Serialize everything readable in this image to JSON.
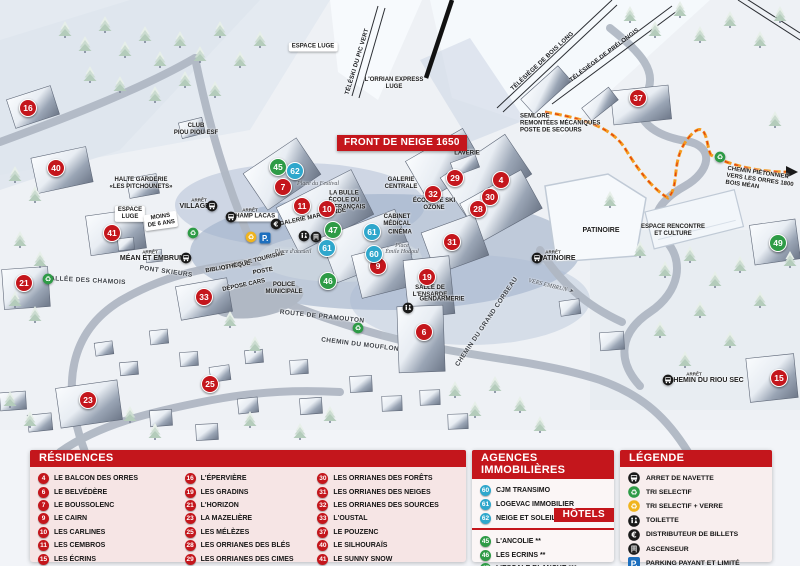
{
  "map": {
    "banner": "FRONT DE NEIGE 1650",
    "markers": [
      {
        "n": "16",
        "t": "res",
        "x": 28,
        "y": 108
      },
      {
        "n": "40",
        "t": "res",
        "x": 56,
        "y": 168
      },
      {
        "n": "41",
        "t": "res",
        "x": 112,
        "y": 233
      },
      {
        "n": "21",
        "t": "res",
        "x": 24,
        "y": 283
      },
      {
        "n": "33",
        "t": "res",
        "x": 204,
        "y": 297
      },
      {
        "n": "23",
        "t": "res",
        "x": 88,
        "y": 400
      },
      {
        "n": "25",
        "t": "res",
        "x": 210,
        "y": 384
      },
      {
        "n": "7",
        "t": "res",
        "x": 283,
        "y": 187
      },
      {
        "n": "11",
        "t": "res",
        "x": 302,
        "y": 206
      },
      {
        "n": "10",
        "t": "res",
        "x": 327,
        "y": 209
      },
      {
        "n": "9",
        "t": "res",
        "x": 378,
        "y": 266
      },
      {
        "n": "19",
        "t": "res",
        "x": 427,
        "y": 277
      },
      {
        "n": "6",
        "t": "res",
        "x": 424,
        "y": 332
      },
      {
        "n": "29",
        "t": "res",
        "x": 455,
        "y": 178
      },
      {
        "n": "32",
        "t": "res",
        "x": 433,
        "y": 194
      },
      {
        "n": "4",
        "t": "res",
        "x": 501,
        "y": 180
      },
      {
        "n": "30",
        "t": "res",
        "x": 490,
        "y": 197
      },
      {
        "n": "28",
        "t": "res",
        "x": 478,
        "y": 209
      },
      {
        "n": "31",
        "t": "res",
        "x": 452,
        "y": 242
      },
      {
        "n": "37",
        "t": "res",
        "x": 638,
        "y": 98
      },
      {
        "n": "15",
        "t": "res",
        "x": 779,
        "y": 378
      },
      {
        "n": "45",
        "t": "hotel",
        "x": 278,
        "y": 167
      },
      {
        "n": "47",
        "t": "hotel",
        "x": 333,
        "y": 230
      },
      {
        "n": "46",
        "t": "hotel",
        "x": 328,
        "y": 281
      },
      {
        "n": "49",
        "t": "hotel",
        "x": 778,
        "y": 243
      },
      {
        "n": "62",
        "t": "agency",
        "x": 295,
        "y": 171
      },
      {
        "n": "61",
        "t": "agency",
        "x": 327,
        "y": 248
      },
      {
        "n": "61",
        "t": "agency",
        "x": 372,
        "y": 232
      },
      {
        "n": "60",
        "t": "agency",
        "x": 374,
        "y": 254
      }
    ],
    "labels": [
      {
        "text": "ESPACE LUGE",
        "x": 313,
        "y": 47,
        "cls": "pill"
      },
      {
        "text": "CLUB\nPIOU PIOU ESF",
        "x": 196,
        "y": 130
      },
      {
        "text": "HALTE GARDERIE\n«LES PITCHOUNETS»",
        "x": 141,
        "y": 184
      },
      {
        "text": "ARRÊT",
        "x": 199,
        "y": 200,
        "cls": "tiny"
      },
      {
        "text": "VILLAGES",
        "x": 197,
        "y": 207,
        "cls": "big"
      },
      {
        "text": "ARRÊT",
        "x": 250,
        "y": 210,
        "cls": "tiny"
      },
      {
        "text": "CHAMP LACAS",
        "x": 253,
        "y": 217,
        "cls": "pill"
      },
      {
        "text": "ESPACE\nLUGE",
        "x": 130,
        "y": 214,
        "cls": "pill"
      },
      {
        "text": "MOINS\nDE 6 ANS",
        "x": 161,
        "y": 221,
        "cls": "pill",
        "rot": -8
      },
      {
        "text": "ARRÊT",
        "x": 150,
        "y": 252,
        "cls": "tiny"
      },
      {
        "text": "MÉAN ET EMBRUN",
        "x": 152,
        "y": 259,
        "cls": "big"
      },
      {
        "text": "ALLÉE DES CHAMOIS",
        "x": 88,
        "y": 281,
        "cls": "road",
        "rot": 3
      },
      {
        "text": "PONT SKIEURS",
        "x": 166,
        "y": 272,
        "cls": "road",
        "rot": 8
      },
      {
        "text": "Place du Festival",
        "x": 318,
        "y": 184,
        "cls": "ital"
      },
      {
        "text": "LA BULLE\nÉCOLE DU\nSKI FRANÇAIS",
        "x": 344,
        "y": 201
      },
      {
        "text": "GALERIE MARCHANDE",
        "x": 313,
        "y": 218,
        "rot": -12
      },
      {
        "text": "GALERIE\nCENTRALE",
        "x": 401,
        "y": 184
      },
      {
        "text": "ÉCOLE DE SKI\nOZONE",
        "x": 434,
        "y": 205
      },
      {
        "text": "CABINET\nMÉDICAL",
        "x": 397,
        "y": 221
      },
      {
        "text": "CINÉMA",
        "x": 400,
        "y": 233
      },
      {
        "text": "Place\nÉmile Hodoul",
        "x": 402,
        "y": 249,
        "cls": "ital"
      },
      {
        "text": "LAVERIE",
        "x": 467,
        "y": 154
      },
      {
        "text": "OFFICE DE TOURISME",
        "x": 253,
        "y": 262,
        "rot": -14
      },
      {
        "text": "BIBLIOTHÈQUE",
        "x": 228,
        "y": 268,
        "rot": -10
      },
      {
        "text": "POSTE",
        "x": 263,
        "y": 272,
        "rot": -10
      },
      {
        "text": "DÉPOSE CARS",
        "x": 244,
        "y": 286,
        "rot": -12
      },
      {
        "text": "POLICE\nMUNICIPALE",
        "x": 284,
        "y": 289
      },
      {
        "text": "Place d'accueil",
        "x": 293,
        "y": 252,
        "cls": "ital"
      },
      {
        "text": "ROUTE DE PRAMOUTON",
        "x": 322,
        "y": 317,
        "cls": "road",
        "rot": 6
      },
      {
        "text": "CHEMIN DU MOUFLON",
        "x": 360,
        "y": 345,
        "cls": "road",
        "rot": 7
      },
      {
        "text": "CHEMIN DU GRAND CORBEAU",
        "x": 487,
        "y": 322,
        "cls": "road",
        "rot": -56
      },
      {
        "text": "SALLE DE\nL'ENSARDE",
        "x": 430,
        "y": 292
      },
      {
        "text": "GENDARMERIE",
        "x": 442,
        "y": 300
      },
      {
        "text": "PATINOIRE",
        "x": 601,
        "y": 231,
        "cls": "big"
      },
      {
        "text": "ARRÊT",
        "x": 553,
        "y": 252,
        "cls": "tiny"
      },
      {
        "text": "PATINOIRE",
        "x": 557,
        "y": 259,
        "cls": "big"
      },
      {
        "text": "VERS EMBRUN ➤",
        "x": 551,
        "y": 286,
        "cls": "ital",
        "rot": 14
      },
      {
        "text": "ESPACE RENCONTRE\nET CULTURE",
        "x": 673,
        "y": 231
      },
      {
        "text": "SEMLORE\nREMONTÉES MÉCANIQUES\nPOSTE DE SECOURS",
        "x": 520,
        "y": 124,
        "cls": "left"
      },
      {
        "text": "TÉLÉSKI DU PIC VERT",
        "x": 358,
        "y": 62,
        "cls": "lift",
        "rot": -73
      },
      {
        "text": "L'ORRIAN EXPRESS\nLUGE",
        "x": 394,
        "y": 84
      },
      {
        "text": "TÉLÉSIÈGE DE BOIS LONG",
        "x": 543,
        "y": 62,
        "cls": "lift",
        "rot": -43
      },
      {
        "text": "TÉLÉSIÈGE DE PRÉLONGIS",
        "x": 605,
        "y": 56,
        "cls": "lift",
        "rot": -37
      },
      {
        "text": "CHEMIN PIÉTONNIER\nVERS LES ORRES 1800\nBOIS MÉAN",
        "x": 726,
        "y": 181,
        "cls": "left",
        "rot": 8
      },
      {
        "text": "ARRÊT",
        "x": 694,
        "y": 374,
        "cls": "tiny"
      },
      {
        "text": "CHEMIN DU RIOU SEC",
        "x": 706,
        "y": 381,
        "cls": "big"
      }
    ],
    "icons": [
      {
        "name": "bus-icon",
        "x": 212,
        "y": 206
      },
      {
        "name": "bus-icon",
        "x": 231,
        "y": 217
      },
      {
        "name": "bus-icon",
        "x": 186,
        "y": 258
      },
      {
        "name": "bus-icon",
        "x": 537,
        "y": 258
      },
      {
        "name": "bus-icon",
        "x": 668,
        "y": 380
      },
      {
        "name": "recycle-green-icon",
        "x": 193,
        "y": 233
      },
      {
        "name": "recycle-green-icon",
        "x": 48,
        "y": 279
      },
      {
        "name": "recycle-green-icon",
        "x": 358,
        "y": 328
      },
      {
        "name": "recycle-green-icon",
        "x": 720,
        "y": 157
      },
      {
        "name": "recycle-yellow-icon",
        "x": 251,
        "y": 237
      },
      {
        "name": "parking-icon",
        "x": 265,
        "y": 238
      },
      {
        "name": "euro-icon",
        "x": 276,
        "y": 224
      },
      {
        "name": "toilette-icon",
        "x": 304,
        "y": 236
      },
      {
        "name": "ascenseur-icon",
        "x": 316,
        "y": 237
      },
      {
        "name": "toilette-icon",
        "x": 408,
        "y": 308
      }
    ]
  },
  "legend_panel": {
    "residences": {
      "title": "RÉSIDENCES",
      "items": [
        {
          "n": "4",
          "label": "LE BALCON DES ORRES"
        },
        {
          "n": "6",
          "label": "LE BELVÉDÈRE"
        },
        {
          "n": "7",
          "label": "LE BOUSSOLENC"
        },
        {
          "n": "9",
          "label": "LE CAIRN"
        },
        {
          "n": "10",
          "label": "LES CARLINES"
        },
        {
          "n": "11",
          "label": "LES CEMBROS"
        },
        {
          "n": "15",
          "label": "LES ÉCRINS"
        },
        {
          "n": "16",
          "label": "L'ÉPERVIÈRE"
        },
        {
          "n": "19",
          "label": "LES GRADINS"
        },
        {
          "n": "21",
          "label": "L'HORIZON"
        },
        {
          "n": "23",
          "label": "LA MAZELIÈRE"
        },
        {
          "n": "25",
          "label": "LES MÉLÈZES"
        },
        {
          "n": "28",
          "label": "LES ORRIANES DES BLÉS"
        },
        {
          "n": "29",
          "label": "LES ORRIANES DES CIMES"
        },
        {
          "n": "30",
          "label": "LES ORRIANES DES FORÊTS"
        },
        {
          "n": "31",
          "label": "LES ORRIANES DES NEIGES"
        },
        {
          "n": "32",
          "label": "LES ORRIANES DES SOURCES"
        },
        {
          "n": "33",
          "label": "L'OUSTAL"
        },
        {
          "n": "37",
          "label": "LE POUZENC"
        },
        {
          "n": "40",
          "label": "LE SILHOURAÏS"
        },
        {
          "n": "41",
          "label": "LE SUNNY SNOW"
        }
      ]
    },
    "agencies": {
      "title": "AGENCES IMMOBILIÈRES",
      "items": [
        {
          "n": "60",
          "label": "CJM TRANSIMO"
        },
        {
          "n": "61",
          "label": "LOGEVAC IMMOBILIER"
        },
        {
          "n": "62",
          "label": "NEIGE ET SOLEIL"
        }
      ]
    },
    "hotels": {
      "title": "HÔTELS",
      "items": [
        {
          "n": "45",
          "label": "L'ANCOLIE **"
        },
        {
          "n": "46",
          "label": "LES ECRINS **"
        },
        {
          "n": "47",
          "label": "L'ESCALE BLANCHE ***"
        },
        {
          "n": "49",
          "label": "LES TRAPPEURS **"
        }
      ]
    },
    "legende": {
      "title": "LÉGENDE",
      "items": [
        {
          "icon": "bus-icon",
          "label": "ARRET DE NAVETTE"
        },
        {
          "icon": "recycle-green-icon",
          "label": "TRI SELECTIF"
        },
        {
          "icon": "recycle-yellow-icon",
          "label": "TRI SELECTIF + VERRE"
        },
        {
          "icon": "toilette-icon",
          "label": "TOILETTE"
        },
        {
          "icon": "euro-icon",
          "label": "DISTRIBUTEUR DE BILLETS"
        },
        {
          "icon": "ascenseur-icon",
          "label": "ASCENSEUR"
        },
        {
          "icon": "parking-icon",
          "label": "PARKING PAYANT ET LIMITÉ"
        }
      ]
    }
  },
  "colors": {
    "accent_red": "#c4161c",
    "agency_blue": "#2fa7cc",
    "hotel_green": "#2e9b46",
    "parking_blue": "#1d6fbe",
    "path_orange": "#f59a1e"
  }
}
